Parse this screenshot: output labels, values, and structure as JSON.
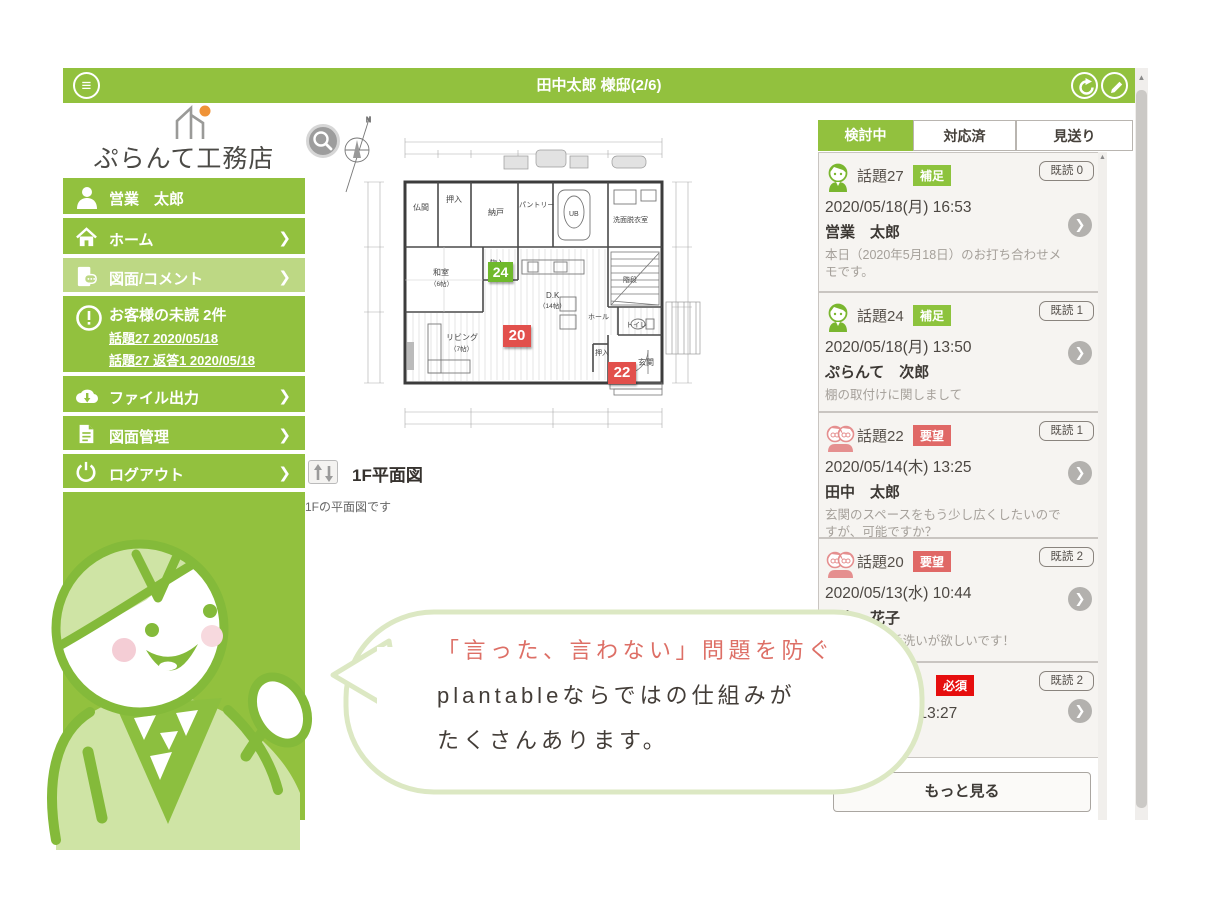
{
  "header": {
    "title": "田中太郎 様邸(2/6)"
  },
  "icons": {
    "hamburger": "≡",
    "chevron": "❯",
    "up_arrow": "▲",
    "pencil": "✎"
  },
  "sidebar": {
    "logo": "ぷらんて工務店",
    "user": "営業　太郎",
    "nav": [
      {
        "label": "ホーム"
      },
      {
        "label": "図面/コメント"
      },
      {
        "label": "ファイル出力"
      },
      {
        "label": "図面管理"
      },
      {
        "label": "ログアウト"
      }
    ],
    "unread": {
      "title": "お客様の未読 2件",
      "links": [
        "話題27 2020/05/18",
        "話題27 返答1 2020/05/18"
      ]
    }
  },
  "main": {
    "caption": "1F平面図",
    "description": "1Fの平面図です",
    "plan": {
      "compass": "N",
      "rooms": [
        {
          "name": "仏間"
        },
        {
          "name": "押入"
        },
        {
          "name": "納戸"
        },
        {
          "name": "パントリー"
        },
        {
          "name": "UB"
        },
        {
          "name": "洗面脱衣室"
        },
        {
          "name": "和室",
          "size": "（6帖）"
        },
        {
          "name": "物入"
        },
        {
          "name": "D.K",
          "size": "（14帖）"
        },
        {
          "name": "階段"
        },
        {
          "name": "ホール"
        },
        {
          "name": "トイレ"
        },
        {
          "name": "リビング",
          "size": "（7帖）"
        },
        {
          "name": "押入"
        },
        {
          "name": "玄関"
        }
      ],
      "markers": [
        {
          "no": "24",
          "color": "#6fb92c"
        },
        {
          "no": "20",
          "color": "#e2504c"
        },
        {
          "no": "22",
          "color": "#e2504c"
        }
      ]
    }
  },
  "panel": {
    "tabs": [
      {
        "label": "検討中",
        "active": true
      },
      {
        "label": "対応済",
        "active": false
      },
      {
        "label": "見送り",
        "active": false
      }
    ],
    "cards": [
      {
        "topic": "話題27",
        "badge": "補足",
        "read": "既読 0",
        "datetime": "2020/05/18(月) 16:53",
        "author": "営業　太郎",
        "body": "本日（2020年5月18日）のお打ち合わせメモです。"
      },
      {
        "topic": "話題24",
        "badge": "補足",
        "read": "既読 1",
        "datetime": "2020/05/18(月) 13:50",
        "author": "ぷらんて　次郎",
        "body": "棚の取付けに関しまして"
      },
      {
        "topic": "話題22",
        "badge": "要望",
        "read": "既読 1",
        "datetime": "2020/05/14(木) 13:25",
        "author": "田中　太郎",
        "body": "玄関のスペースをもう少し広くしたいのですが、可能ですか？"
      },
      {
        "topic": "話題20",
        "badge": "要望",
        "read": "既読 2",
        "datetime": "2020/05/13(水) 10:44",
        "author": "田中　花子",
        "body": "ージの手洗いが欲しいです！"
      },
      {
        "topic": "",
        "badge": "必須",
        "read": "既読 2",
        "datetime": ") 13:27",
        "author": "",
        "body": ""
      }
    ],
    "more": "もっと見る"
  },
  "bubble": {
    "line1": "「言った、言わない」問題を防ぐ",
    "line2": "plantableならではの仕組みが",
    "line3": "たくさんあります。"
  },
  "colors": {
    "green": "#92c13e",
    "green_active": "#bdd884",
    "badge_green": "#8dc33d",
    "badge_red": "#e06866",
    "badge_red_bright": "#e60e0e",
    "marker_green": "#6fb92c",
    "marker_red": "#e2504c",
    "bubble_border": "#dce8c3",
    "bubble_accent_text": "#dd6f66"
  }
}
